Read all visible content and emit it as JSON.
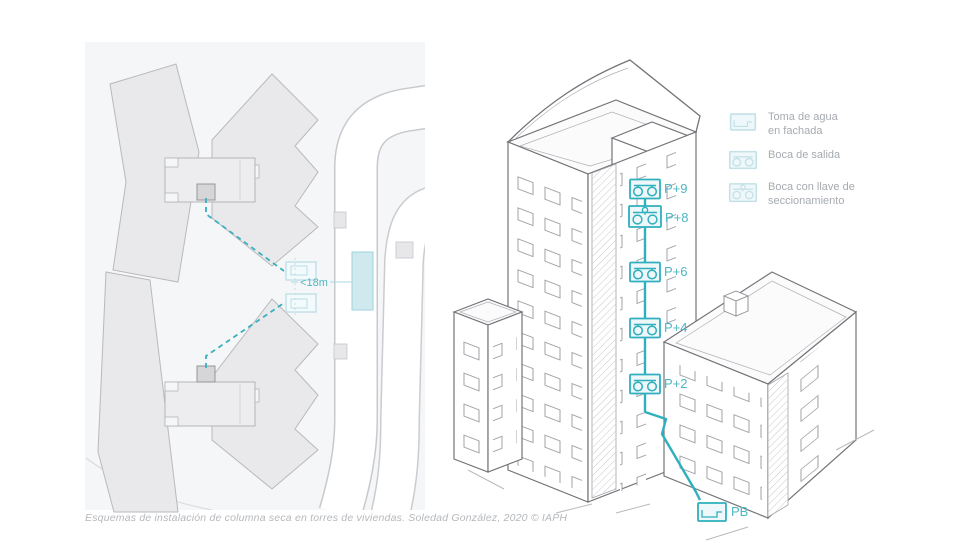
{
  "caption": "Esquemas de instalación de columna seca en torres de viviendas. Soledad González, 2020 © IAPH",
  "site_plan": {
    "distance_label": "<18m"
  },
  "tower": {
    "floor_markers": [
      {
        "label": "P+9",
        "icon": "boca-de-salida"
      },
      {
        "label": "P+8",
        "icon": "boca-con-llave-de-seccionamiento"
      },
      {
        "label": "P+6",
        "icon": "boca-de-salida"
      },
      {
        "label": "P+4",
        "icon": "boca-de-salida"
      },
      {
        "label": "P+2",
        "icon": "boca-de-salida"
      },
      {
        "label": "PB",
        "icon": "toma-de-agua-en-fachada"
      }
    ]
  },
  "legend": {
    "items": [
      {
        "name": "toma-de-agua",
        "line1": "Toma de agua",
        "line2": "en fachada"
      },
      {
        "name": "boca-de-salida",
        "line1": "Boca de salida",
        "line2": ""
      },
      {
        "name": "boca-con-llave",
        "line1": "Boca con llave de",
        "line2": "seccionamiento"
      }
    ]
  },
  "colors": {
    "teal": "#2fb0bd",
    "teal_label": "#4db7c3",
    "teal_light_fill": "#cfe9ee",
    "teal_pale_stroke": "#b8dde4",
    "building_gray": "#e9e9eb",
    "building_stroke": "#b9b9bd",
    "plan_background": "#f5f6f7",
    "legend_text": "#a6abb1",
    "caption_text": "#b5b8bb"
  }
}
